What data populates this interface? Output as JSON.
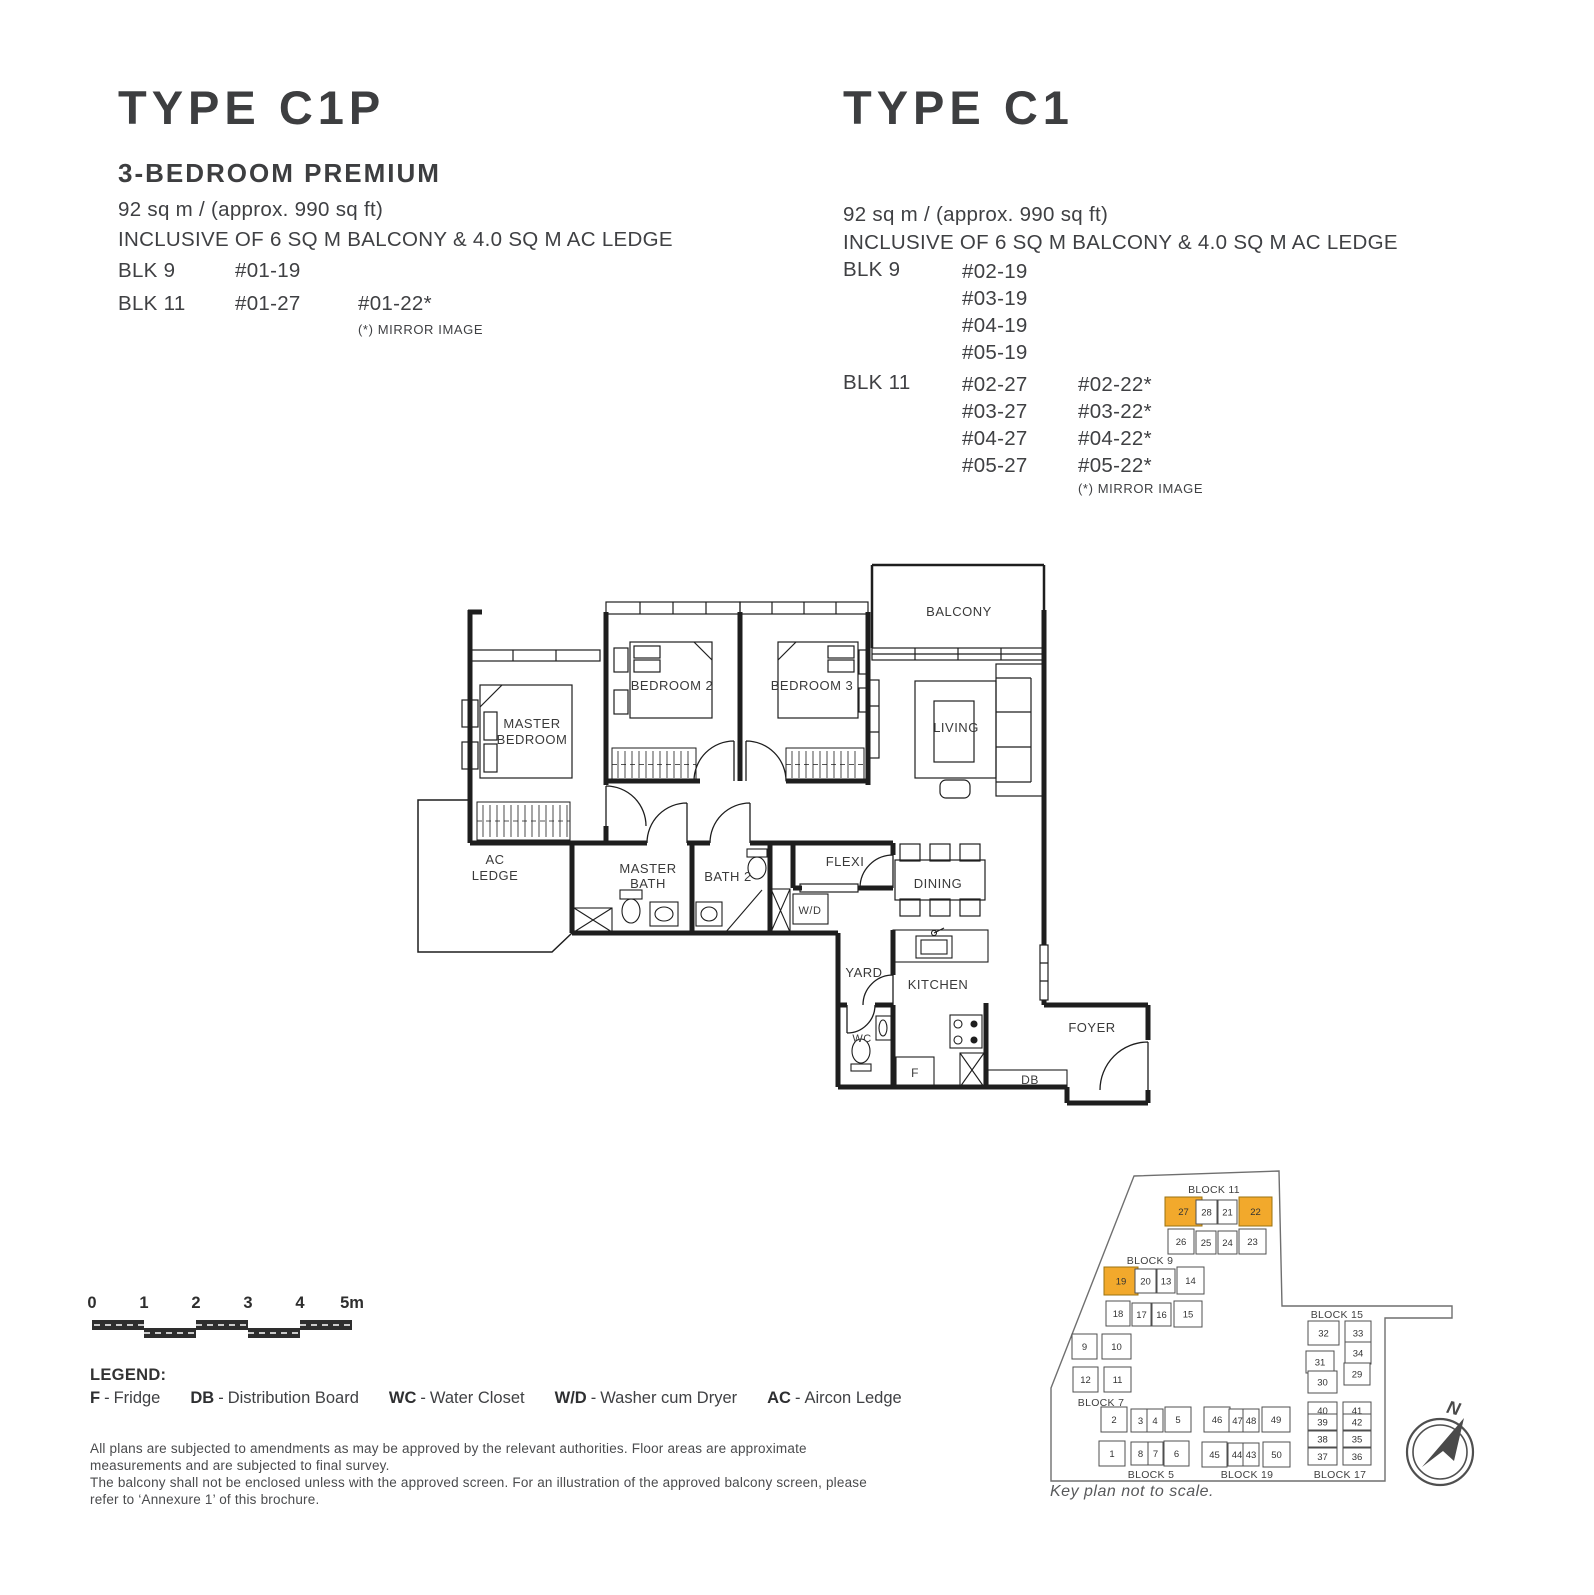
{
  "colors": {
    "highlight_orange": "#F2A92C",
    "text_dark": "#3d3e40",
    "plan_line": "#1e1e1e",
    "keyplan_line": "#6f6f6f"
  },
  "left_unit": {
    "type_title": "TYPE C1P",
    "subtitle": "3-BEDROOM PREMIUM",
    "area": "92 sq m / (approx. 990 sq ft)",
    "inclusive": "INCLUSIVE OF 6 SQ M BALCONY & 4.0 SQ M AC LEDGE",
    "blk9_label": "BLK 9",
    "blk9_unit": "#01-19",
    "blk11_label": "BLK 11",
    "blk11_unit1": "#01-27",
    "blk11_unit2": "#01-22*",
    "mirror_note": "(*) MIRROR IMAGE"
  },
  "right_unit": {
    "type_title": "TYPE C1",
    "area": "92 sq m / (approx. 990 sq ft)",
    "inclusive": "INCLUSIVE OF 6 SQ M BALCONY & 4.0 SQ M AC LEDGE",
    "blk9": {
      "label": "BLK 9",
      "units": [
        "#02-19",
        "#03-19",
        "#04-19",
        "#05-19"
      ]
    },
    "blk11": {
      "label": "BLK 11",
      "col1": [
        "#02-27",
        "#03-27",
        "#04-27",
        "#05-27"
      ],
      "col2": [
        "#02-22*",
        "#03-22*",
        "#04-22*",
        "#05-22*"
      ]
    },
    "mirror_note": "(*) MIRROR IMAGE"
  },
  "floorplan": {
    "rooms": {
      "balcony": "BALCONY",
      "living": "LIVING",
      "bedroom2": "BEDROOM 2",
      "bedroom3": "BEDROOM 3",
      "master1": "MASTER",
      "master2": "BEDROOM",
      "ac1": "AC",
      "ac2": "LEDGE",
      "mbath1": "MASTER",
      "mbath2": "BATH",
      "bath2": "BATH 2",
      "flexi": "FLEXI",
      "wd": "W/D",
      "dining": "DINING",
      "yard": "YARD",
      "kitchen": "KITCHEN",
      "wc": "WC",
      "fridge": "F",
      "db": "DB",
      "foyer": "FOYER"
    }
  },
  "scalebar": {
    "labels": [
      "0",
      "1",
      "2",
      "3",
      "4",
      "5m"
    ]
  },
  "legend": {
    "title": "LEGEND:",
    "separator": "-",
    "items": [
      {
        "abbr": "F",
        "name": "Fridge"
      },
      {
        "abbr": "DB",
        "name": "Distribution Board"
      },
      {
        "abbr": "WC",
        "name": "Water Closet"
      },
      {
        "abbr": "W/D",
        "name": "Washer cum Dryer"
      },
      {
        "abbr": "AC",
        "name": "Aircon Ledge"
      }
    ]
  },
  "disclaimer": [
    "All plans are subjected to amendments as may be approved by the relevant authorities. Floor areas are approximate measurements and are subjected to final survey.",
    "The balcony shall not be enclosed unless with the approved screen. For an illustration of the approved balcony screen, please refer to ‘Annexure 1’ of this brochure."
  ],
  "keyplan": {
    "caption": "Key plan not to scale.",
    "north_label": "N",
    "blocks": [
      {
        "label": "BLOCK 11",
        "lx": 1214,
        "ly": 1193,
        "units": [
          {
            "no": "27",
            "x": 1165,
            "y": 1197,
            "w": 37,
            "h": 29,
            "hl": true
          },
          {
            "no": "28",
            "x": 1196,
            "y": 1200,
            "w": 21,
            "h": 24
          },
          {
            "no": "21",
            "x": 1218,
            "y": 1200,
            "w": 19,
            "h": 24
          },
          {
            "no": "22",
            "x": 1239,
            "y": 1197,
            "w": 33,
            "h": 29,
            "hl": true
          },
          {
            "no": "26",
            "x": 1168,
            "y": 1229,
            "w": 26,
            "h": 25
          },
          {
            "no": "25",
            "x": 1196,
            "y": 1231,
            "w": 20,
            "h": 23
          },
          {
            "no": "24",
            "x": 1218,
            "y": 1231,
            "w": 19,
            "h": 23
          },
          {
            "no": "23",
            "x": 1239,
            "y": 1229,
            "w": 27,
            "h": 25
          }
        ]
      },
      {
        "label": "BLOCK 9",
        "lx": 1150,
        "ly": 1264,
        "units": [
          {
            "no": "19",
            "x": 1104,
            "y": 1267,
            "w": 34,
            "h": 28,
            "hl": true
          },
          {
            "no": "20",
            "x": 1135,
            "y": 1269,
            "w": 21,
            "h": 24
          },
          {
            "no": "13",
            "x": 1157,
            "y": 1269,
            "w": 18,
            "h": 24
          },
          {
            "no": "14",
            "x": 1177,
            "y": 1267,
            "w": 27,
            "h": 27
          },
          {
            "no": "18",
            "x": 1106,
            "y": 1301,
            "w": 24,
            "h": 25
          },
          {
            "no": "17",
            "x": 1132,
            "y": 1303,
            "w": 19,
            "h": 23
          },
          {
            "no": "16",
            "x": 1152,
            "y": 1303,
            "w": 19,
            "h": 23
          },
          {
            "no": "15",
            "x": 1174,
            "y": 1301,
            "w": 28,
            "h": 26
          }
        ]
      },
      {
        "label": "BLOCK 7",
        "lx": 1101,
        "ly": 1406,
        "units": [
          {
            "no": "9",
            "x": 1072,
            "y": 1334,
            "w": 25,
            "h": 25
          },
          {
            "no": "10",
            "x": 1102,
            "y": 1334,
            "w": 29,
            "h": 25
          },
          {
            "no": "12",
            "x": 1073,
            "y": 1367,
            "w": 25,
            "h": 25
          },
          {
            "no": "11",
            "x": 1104,
            "y": 1367,
            "w": 27,
            "h": 25
          }
        ]
      },
      {
        "label": "BLOCK 5",
        "lx": 1151,
        "ly": 1478,
        "units": [
          {
            "no": "2",
            "x": 1101,
            "y": 1407,
            "w": 26,
            "h": 25
          },
          {
            "no": "3",
            "x": 1131,
            "y": 1409,
            "w": 19,
            "h": 23
          },
          {
            "no": "4",
            "x": 1147,
            "y": 1409,
            "w": 16,
            "h": 23
          },
          {
            "no": "5",
            "x": 1165,
            "y": 1407,
            "w": 26,
            "h": 25
          },
          {
            "no": "1",
            "x": 1099,
            "y": 1441,
            "w": 26,
            "h": 25
          },
          {
            "no": "8",
            "x": 1131,
            "y": 1442,
            "w": 19,
            "h": 23
          },
          {
            "no": "7",
            "x": 1148,
            "y": 1442,
            "w": 15,
            "h": 23
          },
          {
            "no": "6",
            "x": 1164,
            "y": 1441,
            "w": 25,
            "h": 25
          }
        ]
      },
      {
        "label": "BLOCK 19",
        "lx": 1247,
        "ly": 1478,
        "units": [
          {
            "no": "46",
            "x": 1204,
            "y": 1407,
            "w": 26,
            "h": 25
          },
          {
            "no": "47",
            "x": 1229,
            "y": 1409,
            "w": 17,
            "h": 23
          },
          {
            "no": "48",
            "x": 1243,
            "y": 1409,
            "w": 16,
            "h": 23
          },
          {
            "no": "49",
            "x": 1262,
            "y": 1407,
            "w": 28,
            "h": 25
          },
          {
            "no": "45",
            "x": 1202,
            "y": 1442,
            "w": 25,
            "h": 25
          },
          {
            "no": "44",
            "x": 1228,
            "y": 1443,
            "w": 18,
            "h": 23
          },
          {
            "no": "43",
            "x": 1243,
            "y": 1443,
            "w": 16,
            "h": 23
          },
          {
            "no": "50",
            "x": 1263,
            "y": 1442,
            "w": 27,
            "h": 25
          }
        ]
      },
      {
        "label": "BLOCK 15",
        "lx": 1337,
        "ly": 1318,
        "units": [
          {
            "no": "32",
            "x": 1308,
            "y": 1321,
            "w": 31,
            "h": 24
          },
          {
            "no": "33",
            "x": 1345,
            "y": 1321,
            "w": 26,
            "h": 24
          },
          {
            "no": "31",
            "x": 1306,
            "y": 1351,
            "w": 28,
            "h": 22
          },
          {
            "no": "34",
            "x": 1345,
            "y": 1342,
            "w": 26,
            "h": 22
          },
          {
            "no": "30",
            "x": 1308,
            "y": 1371,
            "w": 29,
            "h": 22
          },
          {
            "no": "29",
            "x": 1344,
            "y": 1363,
            "w": 26,
            "h": 22
          }
        ]
      },
      {
        "label": "BLOCK 17",
        "lx": 1340,
        "ly": 1478,
        "units": [
          {
            "no": "40",
            "x": 1308,
            "y": 1402,
            "w": 29,
            "h": 17
          },
          {
            "no": "41",
            "x": 1343,
            "y": 1402,
            "w": 28,
            "h": 17
          },
          {
            "no": "39",
            "x": 1308,
            "y": 1414,
            "w": 29,
            "h": 16
          },
          {
            "no": "42",
            "x": 1343,
            "y": 1414,
            "w": 28,
            "h": 16
          },
          {
            "no": "38",
            "x": 1308,
            "y": 1431,
            "w": 29,
            "h": 16
          },
          {
            "no": "35",
            "x": 1343,
            "y": 1431,
            "w": 28,
            "h": 16
          },
          {
            "no": "37",
            "x": 1308,
            "y": 1448,
            "w": 29,
            "h": 17
          },
          {
            "no": "36",
            "x": 1343,
            "y": 1448,
            "w": 28,
            "h": 17
          }
        ]
      }
    ]
  }
}
